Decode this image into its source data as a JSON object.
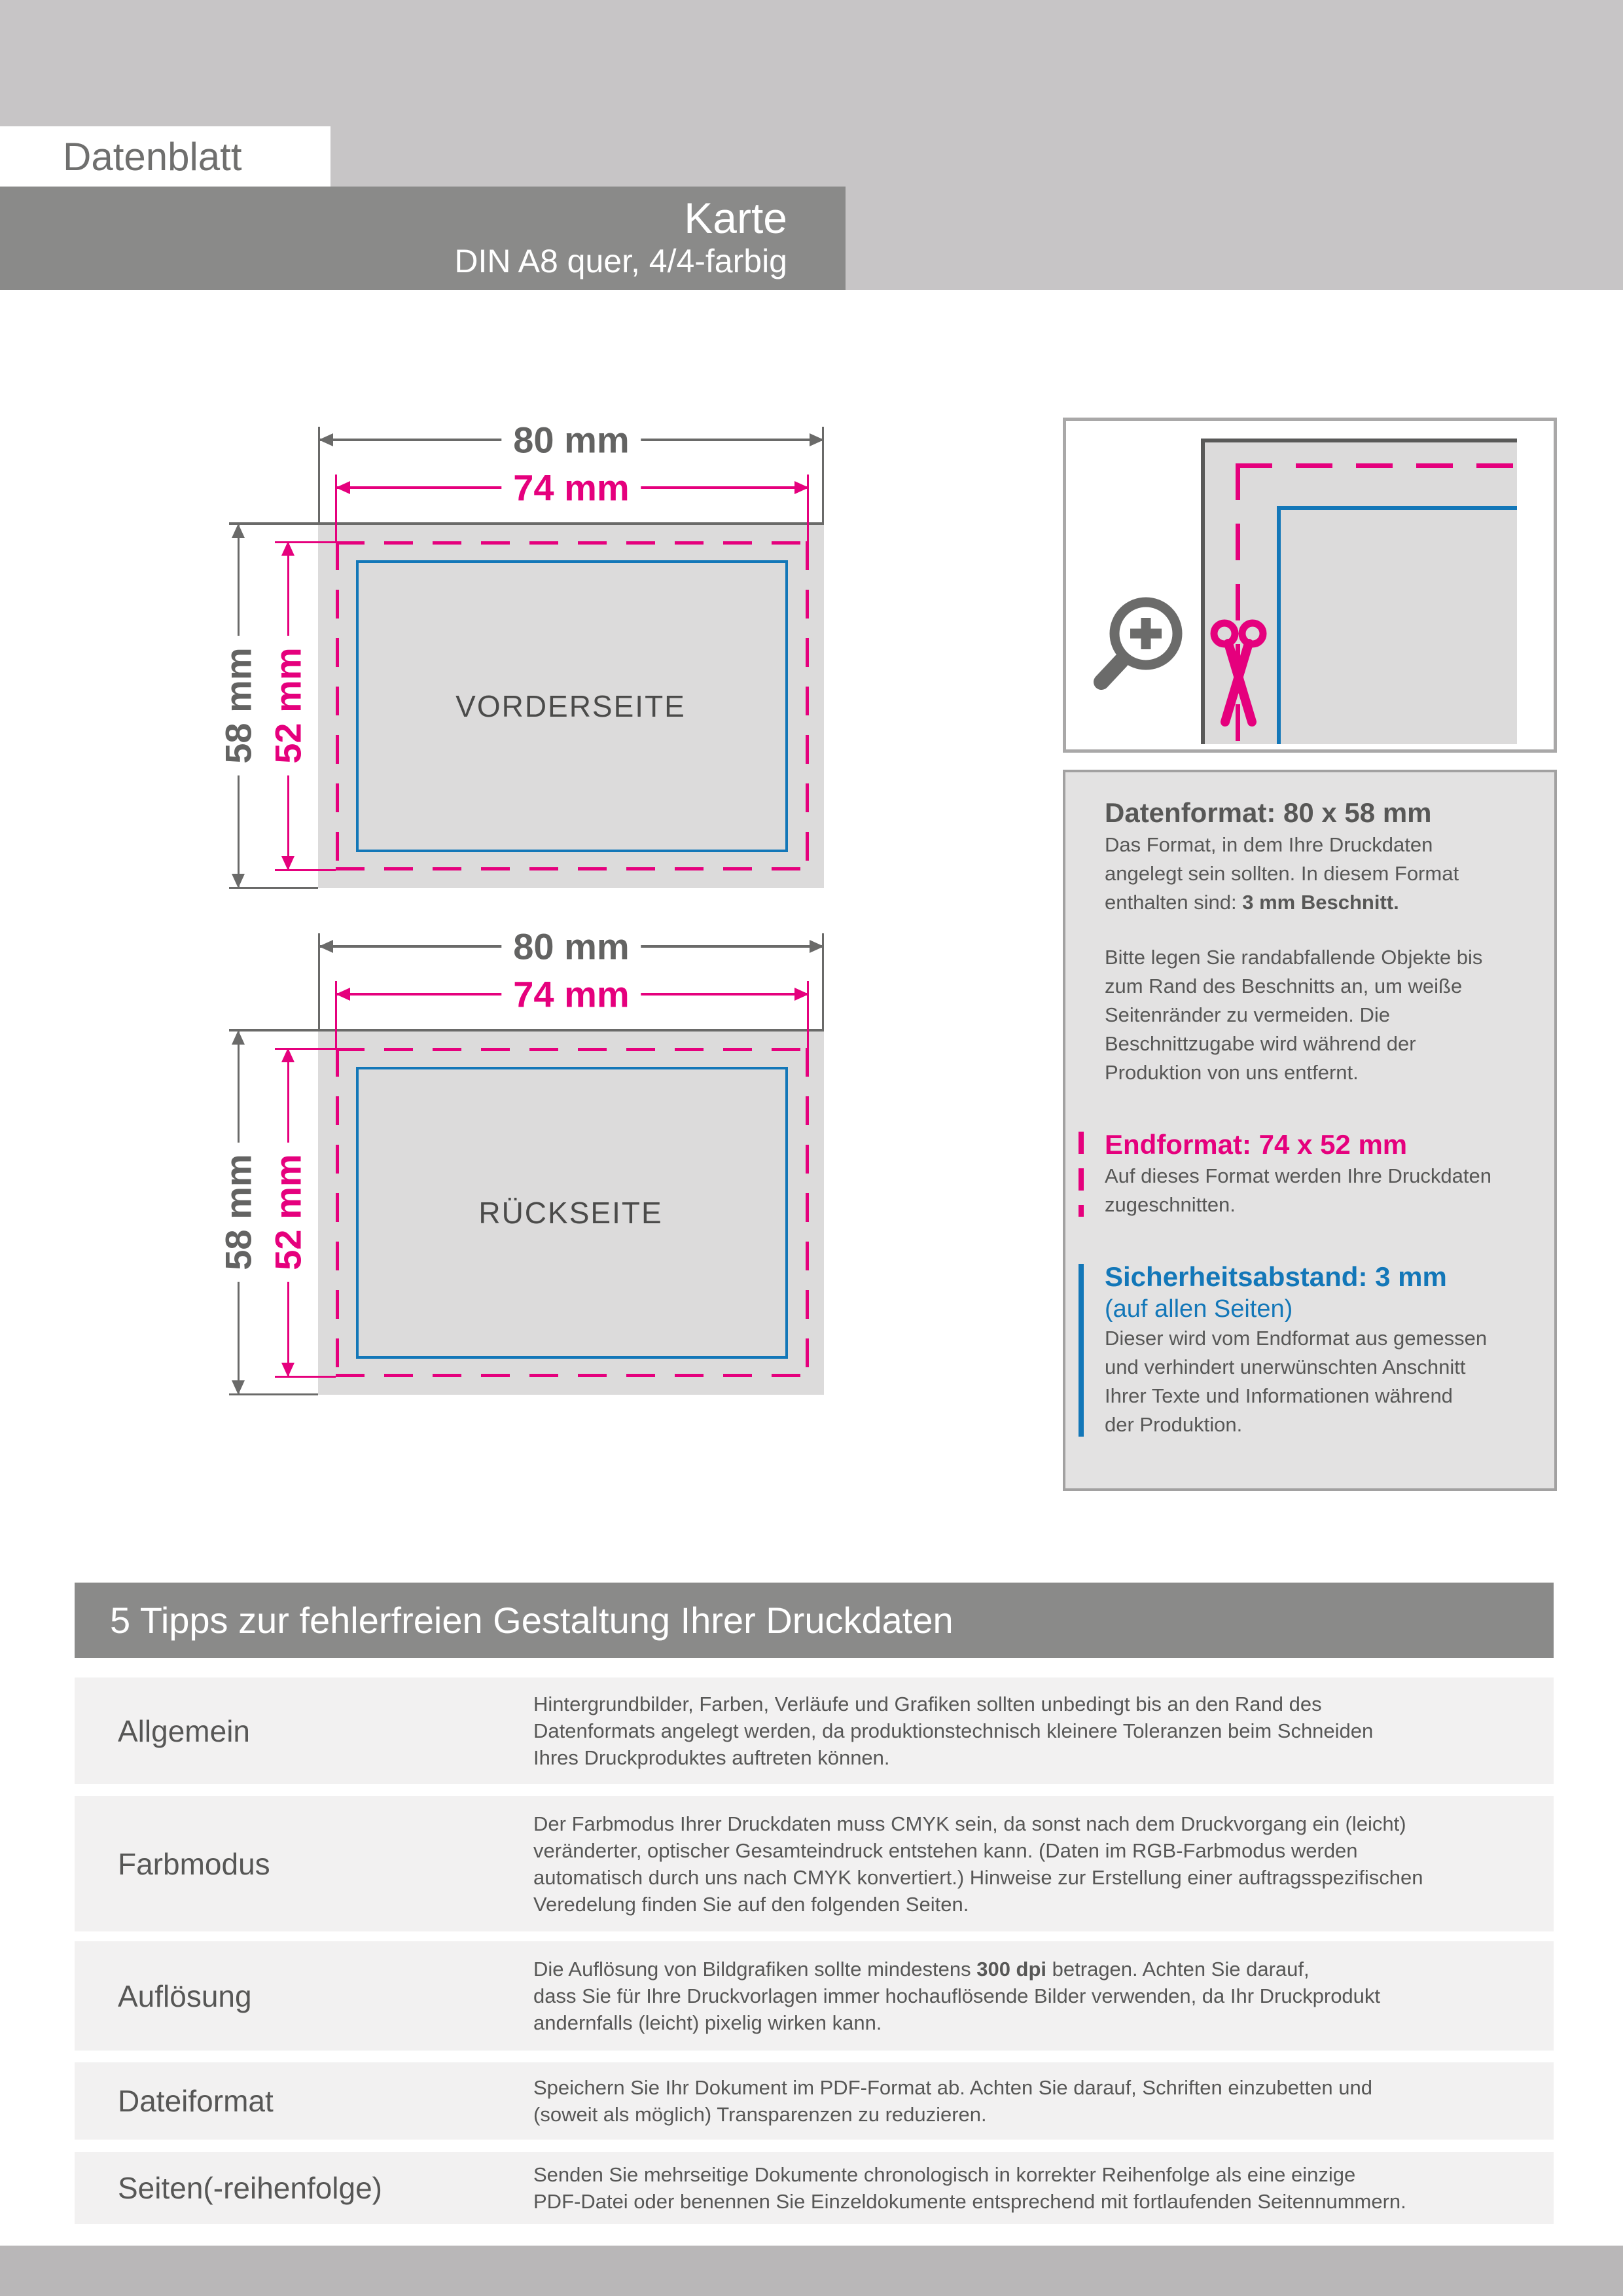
{
  "header": {
    "eyebrow": "Datenblatt",
    "title": "Karte",
    "subtitle": "DIN A8 quer, 4/4-farbig"
  },
  "dimensions": {
    "outer_width": "80 mm",
    "inner_width": "74 mm",
    "outer_height": "58 mm",
    "inner_height": "52 mm"
  },
  "diagrams": {
    "front_label": "VORDERSEITE",
    "back_label": "RÜCKSEITE"
  },
  "info_panel": {
    "datenformat": {
      "heading": "Datenformat: 80 x 58 mm",
      "body_before": "Das Format, in dem Ihre Druckdaten\nangelegt sein sollten. In diesem Format\nenthalten sind: ",
      "body_bold": "3 mm Beschnitt.",
      "body2": "Bitte legen Sie randabfallende Objekte bis\nzum Rand des Beschnitts an, um weiße\nSeitenränder zu vermeiden. Die\nBeschnittzugabe wird während der\nProduktion von uns entfernt."
    },
    "endformat": {
      "heading": "Endformat: 74 x 52 mm",
      "body": "Auf dieses Format werden Ihre Druckdaten\nzugeschnitten."
    },
    "sicherheitsabstand": {
      "heading": "Sicherheitsabstand: 3 mm",
      "subheading": "(auf allen Seiten)",
      "body": "Dieser wird vom Endformat aus gemessen\nund verhindert unerwünschten Anschnitt\nIhrer Texte und Informationen während\nder Produktion."
    }
  },
  "tips": {
    "heading": "5 Tipps zur fehlerfreien Gestaltung Ihrer Druckdaten",
    "rows": [
      {
        "label": "Allgemein",
        "text": "Hintergrundbilder, Farben, Verläufe und Grafiken sollten unbedingt bis an den Rand des\nDatenformats angelegt werden, da produktionstechnisch kleinere Toleranzen beim Schneiden\nIhres Druckproduktes auftreten können.",
        "bold": "",
        "text_after": ""
      },
      {
        "label": "Farbmodus",
        "text": "Der Farbmodus Ihrer Druckdaten muss CMYK sein, da sonst nach dem Druckvorgang ein (leicht)\nveränderter, optischer Gesamteindruck entstehen kann. (Daten im RGB-Farbmodus werden\nautomatisch durch uns nach CMYK konvertiert.) Hinweise zur Erstellung einer auftragsspezifischen\nVeredelung finden Sie  auf den folgenden Seiten.",
        "bold": "",
        "text_after": ""
      },
      {
        "label": "Auflösung",
        "text": "Die Auflösung von Bildgrafiken sollte mindestens ",
        "bold": "300 dpi",
        "text_after": " betragen. Achten Sie darauf,\ndass Sie für Ihre Druckvorlagen immer hochauflösende Bilder verwenden, da Ihr Druckprodukt\nandernfalls (leicht) pixelig wirken kann."
      },
      {
        "label": "Dateiformat",
        "text": "Speichern Sie Ihr Dokument im PDF-Format ab. Achten Sie darauf, Schriften einzubetten und\n(soweit als möglich) Transparenzen zu reduzieren.",
        "bold": "",
        "text_after": ""
      },
      {
        "label": "Seiten(-reihenfolge)",
        "text": "Senden Sie mehrseitige Dokumente chronologisch in korrekter Reihenfolge als eine einzige\nPDF-Datei oder benennen Sie Einzeldokumente entsprechend mit fortlaufenden Seitennummern.",
        "bold": "",
        "text_after": ""
      }
    ]
  },
  "colors": {
    "accent_magenta": "#e5007d",
    "accent_blue": "#1377b8",
    "banner_gray": "#8a8a89",
    "text_gray": "#575756"
  }
}
